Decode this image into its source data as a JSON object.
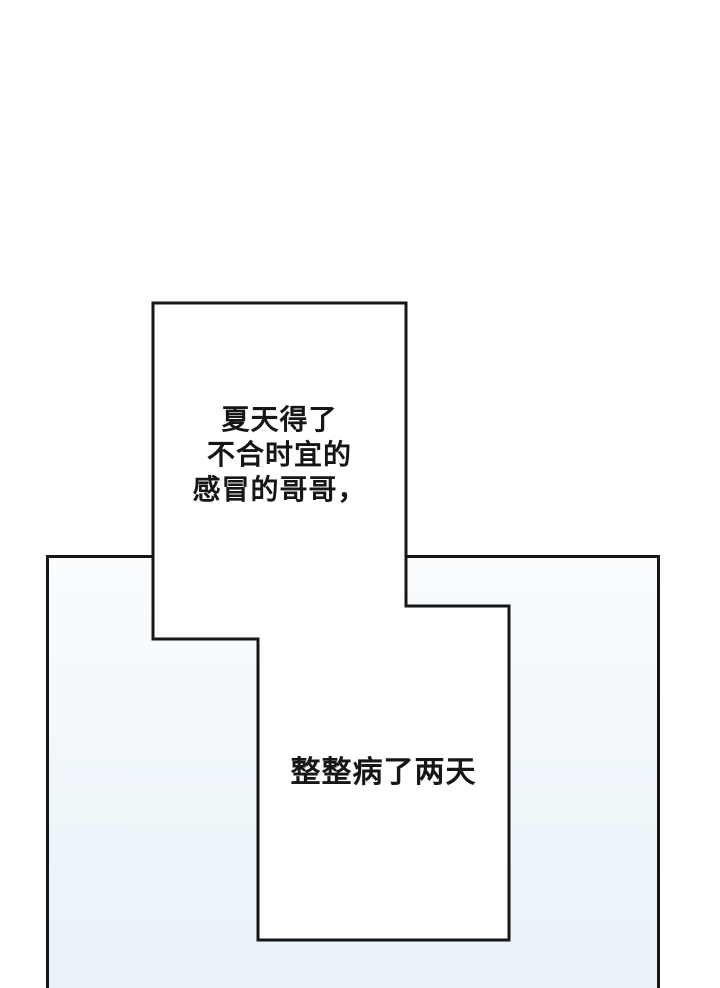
{
  "page": {
    "type": "comic-page",
    "background_color": "#ffffff"
  },
  "colors": {
    "ink": "#161616",
    "panel_border": "#161616",
    "panel_background_top": "#fafcfe",
    "panel_background_bottom": "#e8f2f8",
    "bubble_fill": "#ffffff"
  },
  "bubbles": {
    "top": {
      "lines": [
        "夏天得了",
        "不合时宜的",
        "感冒的哥哥，"
      ]
    },
    "bottom": {
      "lines": [
        "整整病了两天"
      ]
    }
  }
}
